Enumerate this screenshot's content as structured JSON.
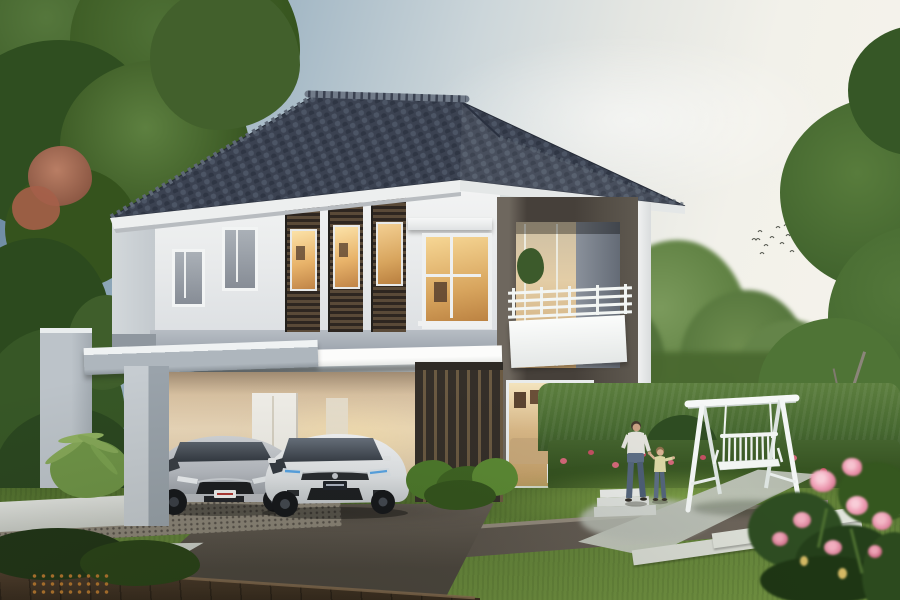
{
  "scene": {
    "title": "Two-storey modern detached house exterior at dusk",
    "setting": "Landscaped garden with lawn, dark paved driveway, hedge, mature trees and a white garden swing",
    "sky": {
      "left_color": "#62809b",
      "right_color": "#f7f4ec",
      "detail": "small flock of birds upper right"
    },
    "house": {
      "storeys": 2,
      "roof": {
        "style": "hipped",
        "tile_color": "#3b4251",
        "ridge_color": "#717b89",
        "fascia_color": "#edefef"
      },
      "walls": {
        "upper_color": "#e9ebed",
        "band_color": "#a2aab3",
        "feature_frame_color": "#46403a",
        "louver_panel_color": "#4a3c30"
      },
      "windows": {
        "frame_color": "#f2f3f4",
        "lit_glow_color": "#f5c878",
        "lit_windows_upper_front": 4
      },
      "balcony": {
        "railing_color": "#f3f6f4",
        "parapet_color": "#fbfcfb"
      },
      "carport": {
        "structure_color": "#b3bbc2",
        "interior_glow_color": "#ecd9bb",
        "back_door_color": "#f2f0ea"
      }
    },
    "vehicles": [
      {
        "name": "silver-sedan",
        "body_color": "#c9ccd1",
        "position": "carport-left"
      },
      {
        "name": "white-hatchback",
        "body_color": "#f2f3f5",
        "headlight_tint": "#5aa7e8",
        "position": "carport-right"
      }
    ],
    "people": [
      {
        "name": "man-walking",
        "shirt_color": "#e3e2dc",
        "pants_color": "#54657c"
      },
      {
        "name": "child-walking",
        "shirt_color": "#dcd8a6",
        "pants_color": "#5d6e85"
      }
    ],
    "garden": {
      "lawn_color": "#63833a",
      "hedge_color": "#466830",
      "driveway_color": "#59524a",
      "deck_color": "#42332a",
      "flower_bed_colors": [
        "#d4687a",
        "#c25062"
      ],
      "foreground_flower_color": "#ef9fb5"
    },
    "swing": {
      "name": "white-a-frame-swing-bench",
      "color": "#f5f7f6"
    }
  }
}
